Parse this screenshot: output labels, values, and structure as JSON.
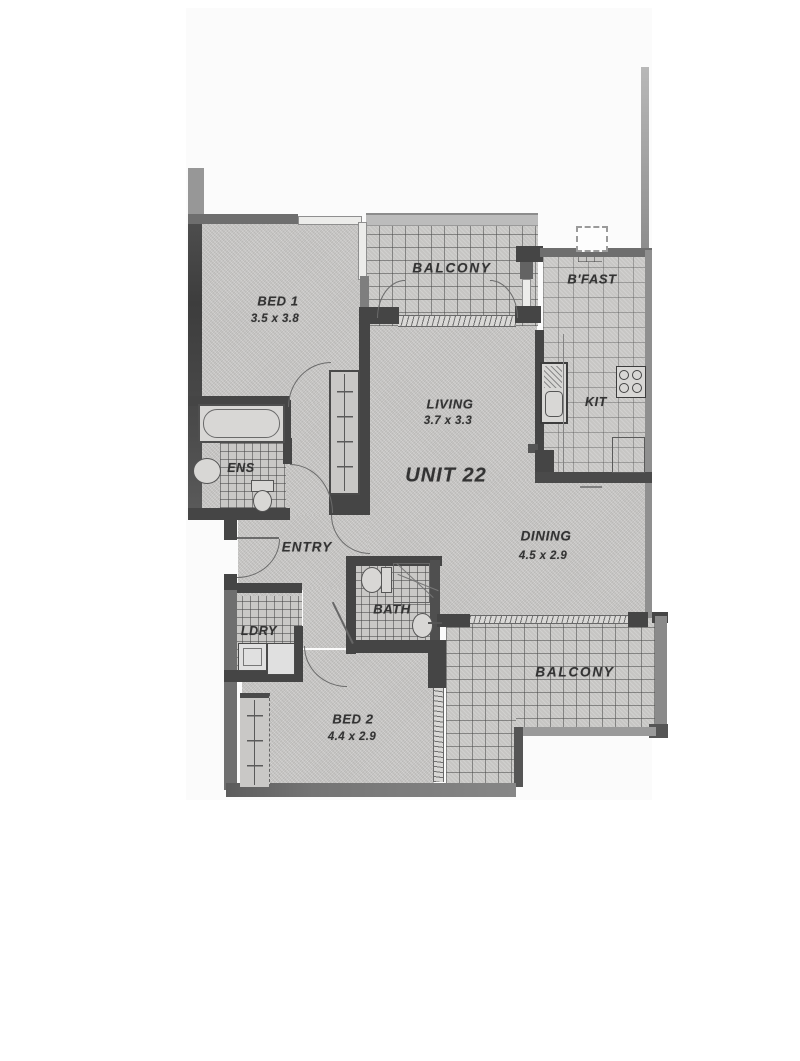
{
  "plan": {
    "unit_title": "UNIT 22",
    "rooms": {
      "bed1": {
        "label": "BED 1",
        "dims": "3.5 x 3.8"
      },
      "balcony_top": {
        "label": "BALCONY"
      },
      "bfast": {
        "label": "B'FAST"
      },
      "living": {
        "label": "LIVING",
        "dims": "3.7 x 3.3"
      },
      "kitchen": {
        "label": "KIT"
      },
      "ensuite": {
        "label": "ENS"
      },
      "entry": {
        "label": "ENTRY"
      },
      "dining": {
        "label": "DINING",
        "dims": "4.5 x 2.9"
      },
      "bath": {
        "label": "BATH"
      },
      "laundry": {
        "label": "LDRY"
      },
      "bed2": {
        "label": "BED 2",
        "dims": "4.4 x 2.9"
      },
      "balcony_bottom": {
        "label": "BALCONY"
      }
    },
    "colors": {
      "wall_dark": "#454545",
      "wall_medium": "#6e6e6e",
      "wall_light": "#979797",
      "floor": "#c8c7c5",
      "text": "#333333",
      "paper": "#ffffff"
    }
  }
}
